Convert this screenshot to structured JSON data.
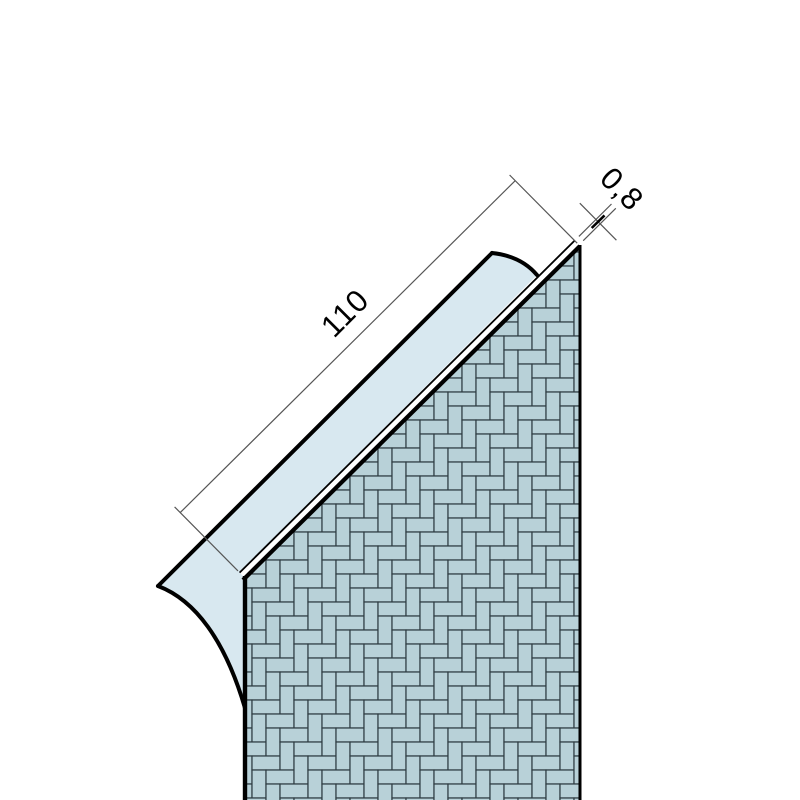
{
  "drawing": {
    "kind": "profile cross-section technical drawing",
    "hatch_style": "herringbone",
    "labels": {
      "profile_length": "110",
      "profile_thickness": "0,8"
    },
    "colors": {
      "background": "#ffffff",
      "plaster_fill": "#d8e8f0",
      "brick_fill": "#b8d1d8",
      "mortar_line": "#2d3b41",
      "outline": "#000000",
      "dimension_line": "#555555",
      "text": "#000000"
    }
  }
}
